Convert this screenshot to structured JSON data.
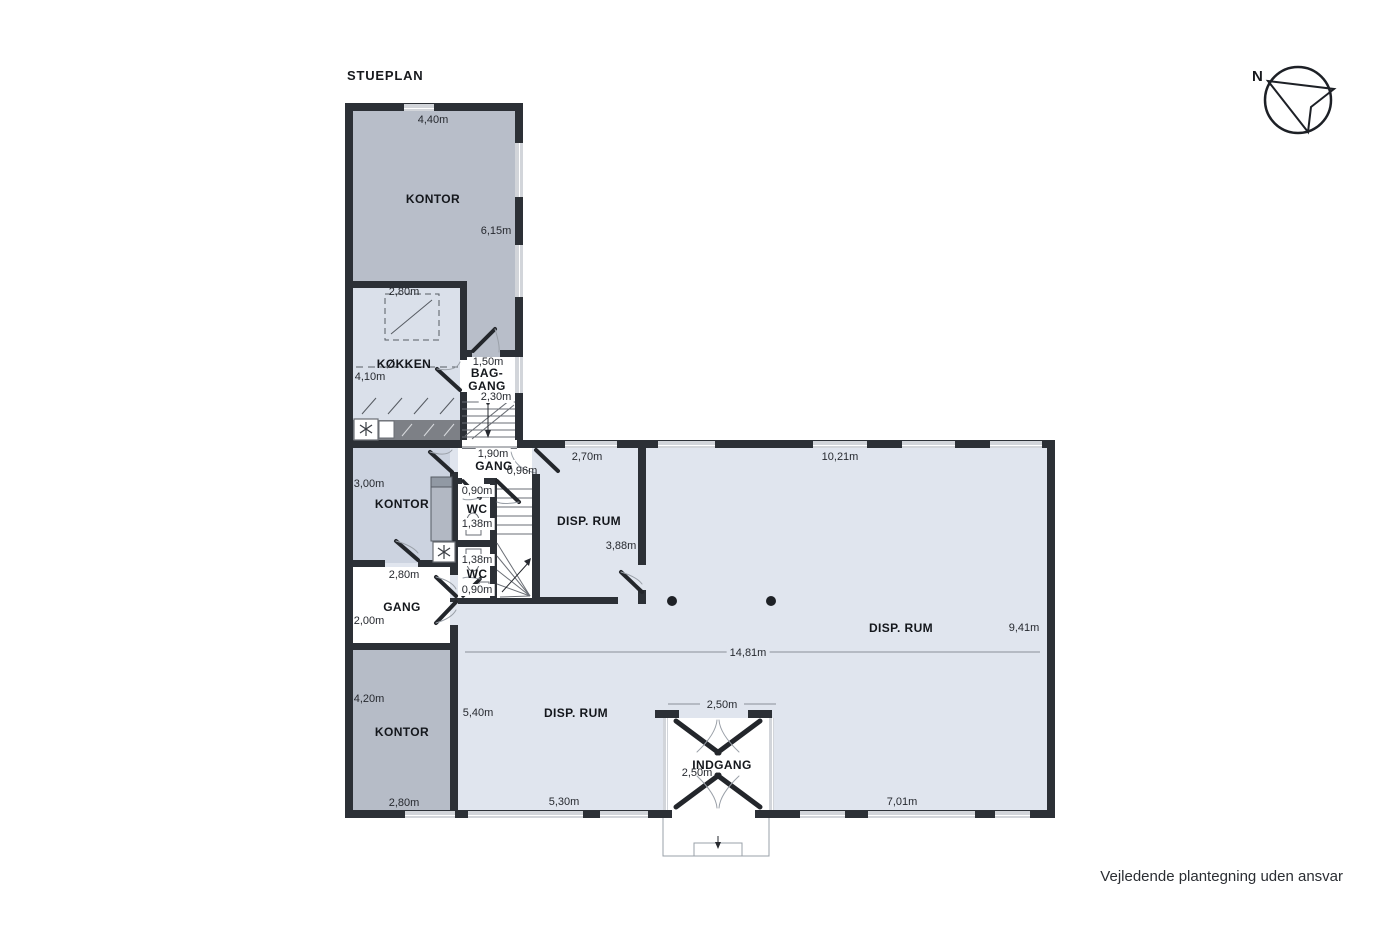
{
  "title": "STUEPLAN",
  "disclaimer": "Vejledende plantegning uden ansvar",
  "compass": {
    "label": "N"
  },
  "colors": {
    "wall": "#2c3036",
    "room_office": "#b8bec9",
    "room_office_light": "#ccd3e0",
    "room_kitchen": "#dae0ea",
    "room_disp": "#e0e5ee",
    "room_white": "#ffffff",
    "window_glass": "#d2d5da"
  },
  "rooms": {
    "kontor_top": {
      "name": "KONTOR",
      "dim_top": "4,40m",
      "dim_right": "6,15m"
    },
    "koekken": {
      "name": "KØKKEN",
      "dim_top": "2,80m",
      "dim_left": "4,10m"
    },
    "baggang": {
      "name_line1": "BAG-",
      "name_line2": "GANG",
      "dim_top": "1,50m",
      "dim_bottom": "2,30m"
    },
    "gang_top": {
      "name": "GANG",
      "dim_width": "1,90m",
      "dim_door": "0,96m"
    },
    "wc_top": {
      "name": "WC",
      "dim_top": "0,90m",
      "dim_bottom": "1,38m"
    },
    "wc_bottom": {
      "name": "WC",
      "dim_top": "1,38m",
      "dim_bottom": "0,90m"
    },
    "kontor_mid": {
      "name": "KONTOR",
      "dim_left": "3,00m"
    },
    "gang_mid": {
      "name": "GANG",
      "dim_top": "2,80m",
      "dim_left": "2,00m"
    },
    "kontor_bottom": {
      "name": "KONTOR",
      "dim_left": "4,20m",
      "dim_bottom": "2,80m"
    },
    "disp_small": {
      "name": "DISP. RUM",
      "dim_top": "2,70m",
      "dim_right": "3,88m"
    },
    "disp_large": {
      "name": "DISP. RUM",
      "dim_top": "10,21m",
      "dim_right": "9,41m",
      "dim_length": "14,81m",
      "dim_bottom": "7,01m"
    },
    "disp_bottom": {
      "name": "DISP. RUM",
      "dim_left": "5,40m",
      "dim_bottom": "5,30m"
    },
    "indgang": {
      "name": "INDGANG",
      "dim_top": "2,50m",
      "dim_left": "2,50m"
    }
  }
}
